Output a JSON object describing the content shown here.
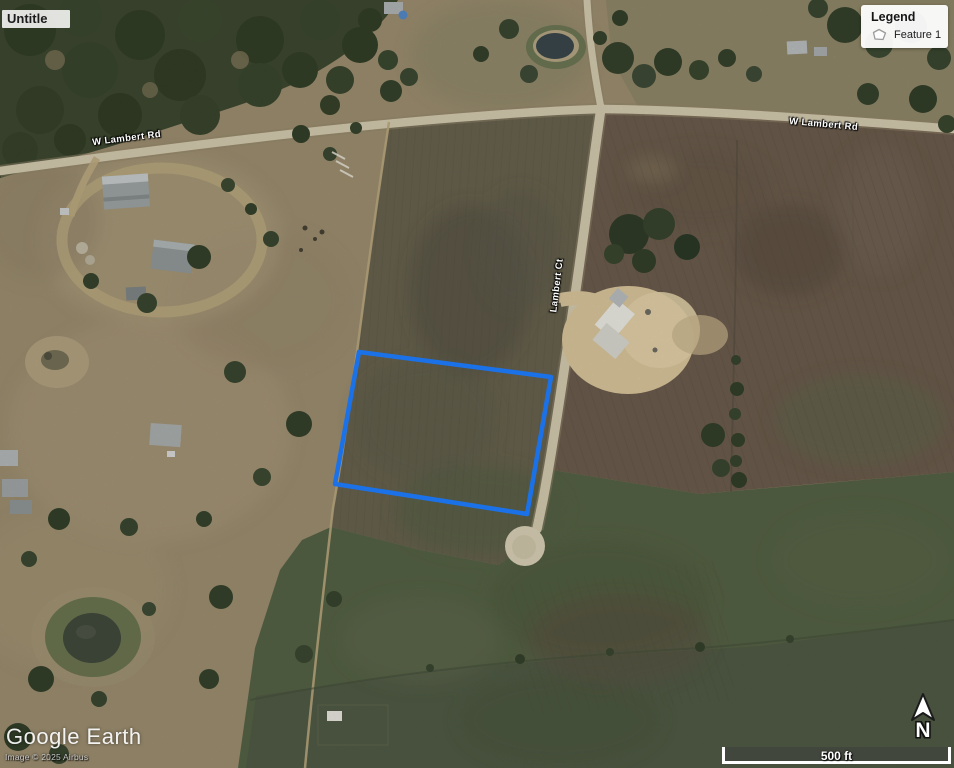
{
  "map_title": "Untitle",
  "legend": {
    "title": "Legend",
    "items": [
      {
        "label": "Feature 1"
      }
    ]
  },
  "feature": {
    "name": "Feature 1",
    "points": "359,352 551,377 527,514 335,484",
    "color": "#1b72e8"
  },
  "road_labels": {
    "w_lambert_rd_west": "W Lambert Rd",
    "w_lambert_rd_east": "W Lambert Rd",
    "lambert_ct": "Lambert Ct"
  },
  "attribution": {
    "watermark": "Google Earth",
    "copyright": "Image © 2025 Airbus"
  },
  "compass": {
    "north_label": "N"
  },
  "scale_bar": {
    "label": "500 ft"
  }
}
